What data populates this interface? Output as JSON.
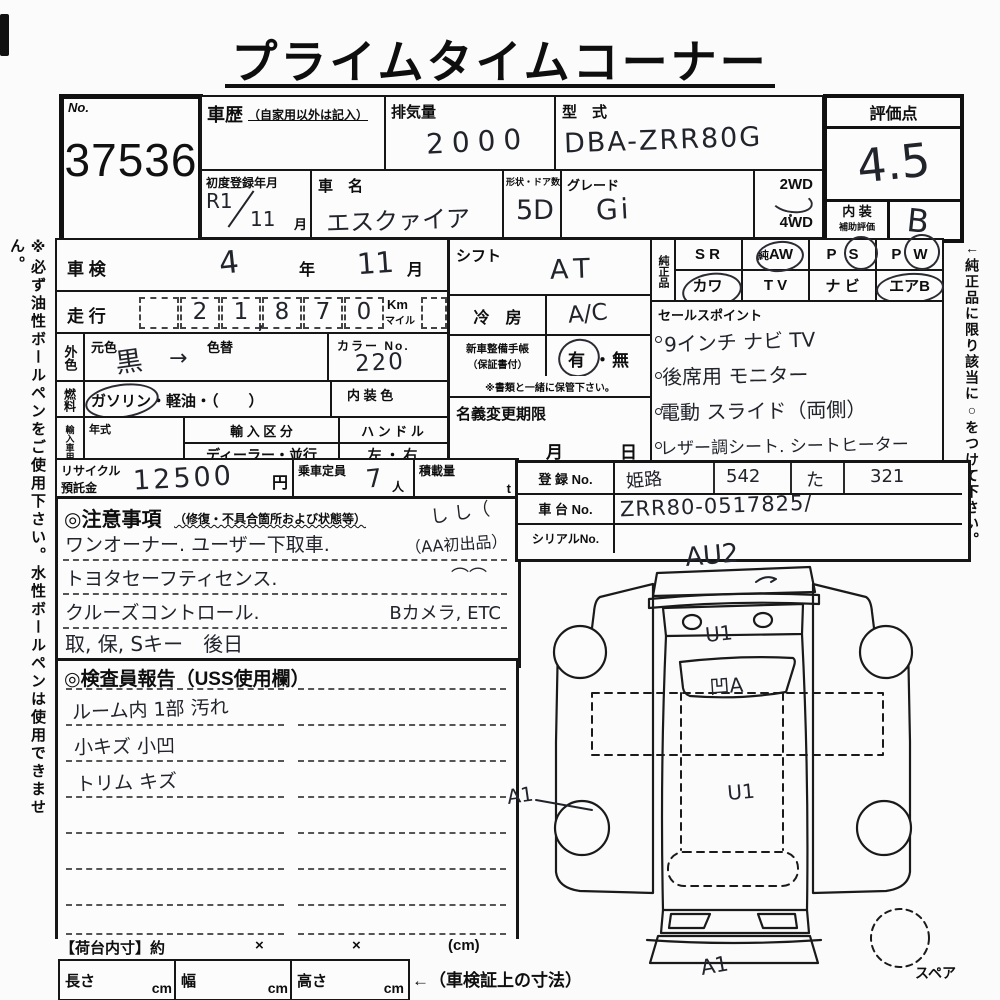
{
  "page": {
    "left_margin_note": "※必ず油性ボールペンをご使用下さい。水性ボールペンは使用できません。",
    "right_margin_note": "←純正品に限り該当に○をつけて下さい。"
  },
  "title": "プライムタイムコーナー",
  "lot": {
    "no_label": "No.",
    "number": "37536"
  },
  "header": {
    "history_label": "車歴",
    "history_note": "（自家用以外は記入）",
    "displacement_label": "排気量",
    "displacement_value": "2000",
    "model_label": "型　式",
    "model_value": "DBA-ZRR80G",
    "first_reg_label": "初度登録年月",
    "first_reg_era": "R1",
    "first_reg_month": "11",
    "month_suffix": "月",
    "name_label": "車　名",
    "name_value": "エスクァイア",
    "shape_label": "形状・ドア数",
    "shape_value": "5D",
    "grade_label": "グレード",
    "grade_value": "Gi",
    "wd2": "2WD",
    "wd4": "4WD"
  },
  "score": {
    "label": "評価点",
    "value": "4.5",
    "interior_label": "内 装",
    "interior_sub": "補助評価",
    "interior_value": "B"
  },
  "shaken": {
    "label": "車 検",
    "year": "4",
    "year_suffix": "年",
    "month": "11",
    "month_suffix": "月"
  },
  "mileage": {
    "label": "走 行",
    "digits": [
      "",
      "2",
      "1",
      "8",
      "7",
      "0"
    ],
    "comma": ",",
    "unit_km": "Km",
    "unit_mile": "マイル"
  },
  "exterior": {
    "label": "外色",
    "base_label": "元色",
    "base_value": "黒",
    "arrow": "→",
    "repaint_label": "色替",
    "color_no_label": "カラー No.",
    "color_no_value": "220"
  },
  "fuel": {
    "label": "燃料",
    "gasoline": "ガソリン",
    "rest": "・軽油・（　　）",
    "interior_color_label": "内 装 色"
  },
  "import": {
    "label": "輸入車用",
    "year_label": "年式",
    "division_label": "輸 入 区 分",
    "division_value": "ディーラー・並行",
    "handle_label": "ハ ン ド ル",
    "handle_value": "左 ・ 右"
  },
  "shift": {
    "label": "シフト",
    "value": "AT"
  },
  "aircon": {
    "label": "冷　房",
    "value": "A/C"
  },
  "record_book": {
    "label1": "新車整備手帳",
    "label2": "（保証書付）",
    "yes": "有",
    "sep": "・",
    "no": "無",
    "note": "※書類と一緒に保管下さい。"
  },
  "name_change": {
    "label": "名義変更期限",
    "month": "月",
    "day": "日"
  },
  "genuine": {
    "label": "純正品",
    "sr": "S R",
    "aw_pre": "純",
    "aw": "AW",
    "ps_p": "P",
    "ps_s": "S",
    "pw_p": "P",
    "pw_w": "W",
    "kawa": "カワ",
    "tv": "T V",
    "navi": "ナ ビ",
    "airb": "エアB"
  },
  "sales": {
    "label": "セールスポイント",
    "lines": [
      "9インチ ナビ TV",
      "後席用 モニター",
      "電動 スライド（両側）",
      "レザー調シート. シートヒーター"
    ]
  },
  "recycle": {
    "label1": "リサイクル",
    "label2": "預託金",
    "value": "12500",
    "unit": "円"
  },
  "capacity": {
    "label": "乗車定員",
    "value": "7",
    "unit": "人"
  },
  "load": {
    "label": "積載量",
    "unit": "t"
  },
  "caution": {
    "title": "◎注意事項",
    "note": "（修復・不具合箇所および状態等）",
    "scribble": "し し（",
    "lines": [
      {
        "main": "ワンオーナー. ユーザー下取車.",
        "right": "（AA初出品）"
      },
      {
        "main": "トヨタセーフティセンス.",
        "right": "⌒⌒"
      },
      {
        "main": "クルーズコントロール.",
        "right": "Bカメラ, ETC"
      },
      {
        "main": "取, 保, Sキー　後日",
        "right": ""
      }
    ]
  },
  "registration": {
    "reg_label": "登 録 No.",
    "area": "姫路",
    "class_no": "542",
    "kana": "た",
    "number": "321",
    "chassis_label": "車 台 No.",
    "chassis_value": "ZRR80-0517825/",
    "serial_label": "シリアルNo."
  },
  "report": {
    "title": "◎検査員報告（USS使用欄）",
    "lines": [
      "ルーム内 1部 汚れ",
      "小キズ 小凹",
      "トリム キズ"
    ]
  },
  "diagram": {
    "front_mark": "AU2",
    "hood_mark": "U1",
    "windshield_mark": "凹A",
    "roof_mark": "U1",
    "side_mark": "A1",
    "rear_mark": "A1",
    "spare_label": "スペア"
  },
  "bed": {
    "label": "【荷台内寸】約",
    "x1": "×",
    "x2": "×",
    "cm": "(cm)",
    "length_label": "長さ",
    "width_label": "幅",
    "height_label": "高さ",
    "cm1": "cm",
    "cm2": "cm",
    "cm3": "cm",
    "note": "←（車検証上の寸法）"
  }
}
